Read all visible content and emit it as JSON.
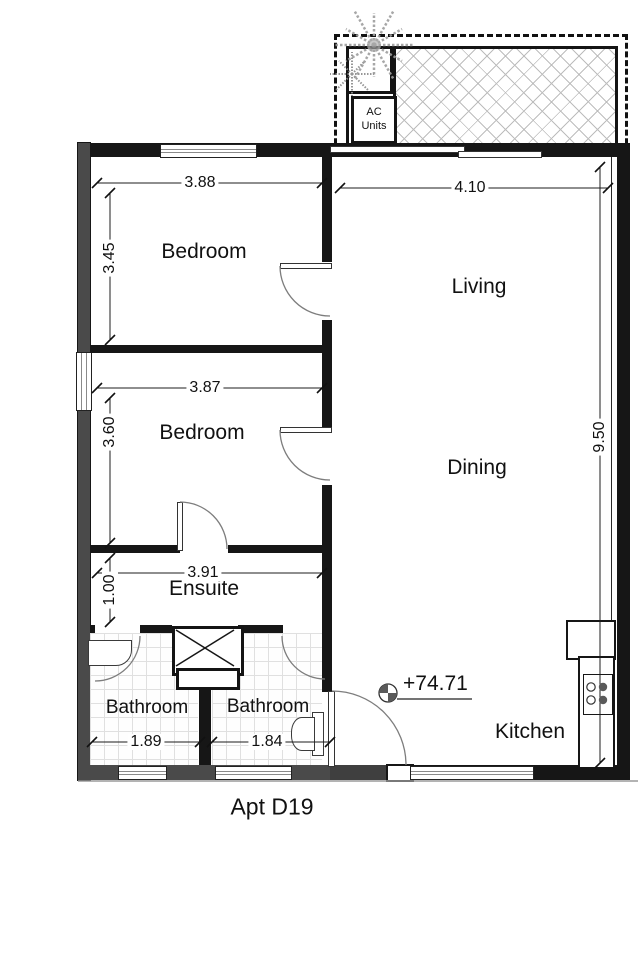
{
  "title": "Apt D19",
  "colors": {
    "wall": "#161616",
    "exterior_gray_wall": "#4a4a4a",
    "hatch_line": "#bdbdbd",
    "tile_line": "#e0e0e0",
    "tree": "#9e9e9e",
    "burner_dark": "#5a5a5a",
    "dimension_text": "#111111"
  },
  "balcony": {
    "ac_label_line1": "AC",
    "ac_label_line2": "Units"
  },
  "rooms": {
    "bedroom1": {
      "label": "Bedroom",
      "width": "3.88",
      "height": "3.45"
    },
    "living": {
      "label": "Living",
      "width": "4.10"
    },
    "bedroom2": {
      "label": "Bedroom",
      "width": "3.87",
      "height": "3.60"
    },
    "dining": {
      "label": "Dining",
      "height": "9.50"
    },
    "ensuite": {
      "label": "Ensuite",
      "width": "3.91",
      "height": "1.00"
    },
    "bathroom1": {
      "label": "Bathroom",
      "width": "1.89"
    },
    "bathroom2": {
      "label": "Bathroom",
      "width": "1.84"
    },
    "kitchen": {
      "label": "Kitchen"
    }
  },
  "level_marker": {
    "value": "+74.71"
  }
}
